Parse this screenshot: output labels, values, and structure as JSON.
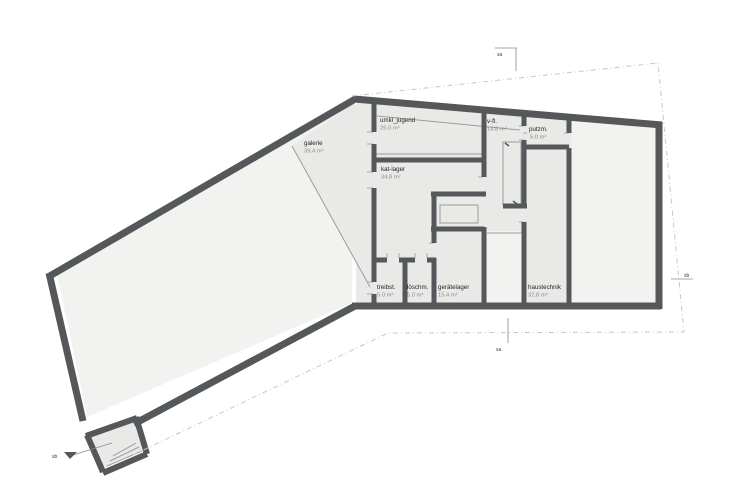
{
  "colors": {
    "wall": "#55585a",
    "room_fill": "#e9e9e7",
    "light_fill": "#f2f2f0",
    "thin_line": "#9c9c9a",
    "tick": "#a9a9a7",
    "boundary": "#c7c7c5",
    "name_text": "#262626",
    "area_text": "#8a8a88",
    "marker_line": "#8a8a88"
  },
  "rooms": [
    {
      "name": "galerie",
      "area": "39.4 m²"
    },
    {
      "name": "umkl_jugend",
      "area": "25.0 m²"
    },
    {
      "name": "v-fl.",
      "area": "14.8 m²"
    },
    {
      "name": "putzm.",
      "area": "5.0 m²"
    },
    {
      "name": "kat-lager",
      "area": "34.8 m²"
    },
    {
      "name": "treibst.",
      "area": "5.0 m²"
    },
    {
      "name": "löschm.",
      "area": "5.0 m²"
    },
    {
      "name": "gerätelager",
      "area": "15.4 m²"
    },
    {
      "name": "haustechnik",
      "area": "32.8 m²"
    }
  ],
  "markers": [
    {
      "label": "sa",
      "tx": 497,
      "ty": 56,
      "lines": [
        [
          495,
          48,
          517,
          48
        ],
        [
          516,
          48,
          516,
          71
        ]
      ]
    },
    {
      "label": "sa",
      "tx": 496,
      "ty": 351,
      "lines": [
        [
          508,
          318,
          508,
          343
        ]
      ]
    },
    {
      "label": "sb",
      "tx": 684,
      "ty": 277,
      "lines": [
        [
          671,
          279,
          693,
          279
        ]
      ]
    },
    {
      "label": "sb",
      "tx": 52,
      "ty": 458,
      "lines": [
        [
          70,
          456,
          112,
          443
        ]
      ],
      "arrow": [
        [
          70,
          459
        ],
        [
          77,
          452
        ],
        [
          64,
          452
        ]
      ]
    }
  ],
  "floorplan": {
    "fills": [
      {
        "kind": "light",
        "pts": [
          [
            354,
            102
          ],
          [
            57,
            274
          ],
          [
            87,
            417
          ],
          [
            352,
            303
          ]
        ],
        "name": "wing-void"
      },
      {
        "kind": "room",
        "pts": [
          [
            292,
            146
          ],
          [
            353,
            104
          ],
          [
            371,
            106
          ],
          [
            371,
            288
          ]
        ],
        "name": "galerie-area"
      },
      {
        "kind": "room",
        "pts": [
          [
            357,
            102
          ],
          [
            656,
            128
          ],
          [
            656,
            303
          ],
          [
            356,
            303
          ]
        ],
        "name": "right-block"
      },
      {
        "kind": "light",
        "pts": [
          [
            571,
            121
          ],
          [
            656,
            128
          ],
          [
            656,
            303
          ],
          [
            571,
            303
          ]
        ],
        "name": "right-room"
      },
      {
        "kind": "light",
        "pts": [
          [
            487,
            231
          ],
          [
            522,
            231
          ],
          [
            522,
            303
          ],
          [
            487,
            303
          ]
        ],
        "name": "stair-corridor"
      },
      {
        "kind": "room",
        "pts": [
          [
            90,
            434
          ],
          [
            134,
            420
          ],
          [
            143,
            451
          ],
          [
            104,
            468
          ]
        ],
        "name": "entry-annex"
      }
    ],
    "outer_walls": [
      [
        354,
        99,
        662,
        125
      ],
      [
        659,
        122,
        659,
        309
      ],
      [
        661,
        306,
        352,
        306
      ],
      [
        355,
        306,
        134,
        424
      ],
      [
        357,
        98,
        48,
        277
      ],
      [
        49,
        273,
        83,
        421
      ]
    ],
    "annex_walls": [
      [
        86,
        436,
        137,
        418
      ],
      [
        87,
        435,
        103,
        472
      ],
      [
        103,
        473,
        147,
        454
      ],
      [
        136,
        417,
        147,
        454
      ]
    ],
    "inner_walls": [
      [
        374,
        101,
        374,
        132
      ],
      [
        374,
        144,
        374,
        172
      ],
      [
        374,
        188,
        374,
        282
      ],
      [
        374,
        294,
        374,
        305
      ],
      [
        372,
        160,
        486,
        160
      ],
      [
        484,
        110,
        484,
        177
      ],
      [
        431,
        194,
        486,
        194
      ],
      [
        434,
        194,
        434,
        243
      ],
      [
        431,
        229,
        484,
        229
      ],
      [
        484,
        227,
        484,
        305
      ],
      [
        434,
        258,
        434,
        305
      ],
      [
        374,
        260,
        387,
        260
      ],
      [
        399,
        260,
        415,
        260
      ],
      [
        427,
        260,
        436,
        260
      ],
      [
        405,
        260,
        405,
        305
      ],
      [
        503,
        206,
        527,
        206
      ],
      [
        524,
        116,
        524,
        126
      ],
      [
        524,
        140,
        524,
        206
      ],
      [
        524,
        222,
        524,
        305
      ],
      [
        524,
        147,
        569,
        147
      ],
      [
        569,
        119,
        569,
        133
      ],
      [
        569,
        148,
        569,
        305
      ]
    ],
    "thin_lines": [
      [
        292,
        146,
        370,
        287
      ],
      [
        377,
        116,
        520,
        130
      ],
      [
        374,
        154,
        484,
        154
      ],
      [
        487,
        233,
        522,
        233
      ]
    ],
    "thin_rects": [
      {
        "x": 503,
        "y": 142,
        "w": 18,
        "h": 63,
        "name": "stair"
      },
      {
        "x": 440,
        "y": 205,
        "w": 38,
        "h": 18,
        "name": "shaft"
      }
    ],
    "stair_ticks": [
      [
        505,
        143,
        509,
        146
      ],
      [
        513,
        201,
        517,
        204
      ]
    ],
    "annex_stairs": [
      [
        107,
        466,
        142,
        451
      ],
      [
        110,
        461,
        139,
        447
      ],
      [
        113,
        456,
        136,
        443
      ]
    ],
    "door_ticks": [
      [
        367,
        132,
        373,
        132
      ],
      [
        367,
        144,
        373,
        144
      ],
      [
        367,
        172,
        373,
        172
      ],
      [
        367,
        188,
        373,
        188
      ],
      [
        367,
        282,
        373,
        282
      ],
      [
        367,
        294,
        373,
        294
      ],
      [
        478,
        177,
        483,
        177
      ],
      [
        478,
        192,
        483,
        192
      ],
      [
        387,
        253,
        387,
        258
      ],
      [
        399,
        253,
        399,
        258
      ],
      [
        415,
        253,
        415,
        258
      ],
      [
        427,
        253,
        427,
        258
      ],
      [
        429,
        243,
        434,
        243
      ],
      [
        429,
        258,
        434,
        258
      ],
      [
        519,
        126,
        524,
        126
      ],
      [
        519,
        140,
        524,
        140
      ],
      [
        519,
        222,
        524,
        222
      ],
      [
        564,
        133,
        569,
        133
      ],
      [
        564,
        148,
        569,
        148
      ],
      [
        523,
        133,
        527,
        133
      ]
    ],
    "boundary": [
      [
        352,
        96
      ],
      [
        658,
        63
      ],
      [
        684,
        332
      ],
      [
        388,
        333
      ],
      [
        133,
        455
      ]
    ]
  }
}
